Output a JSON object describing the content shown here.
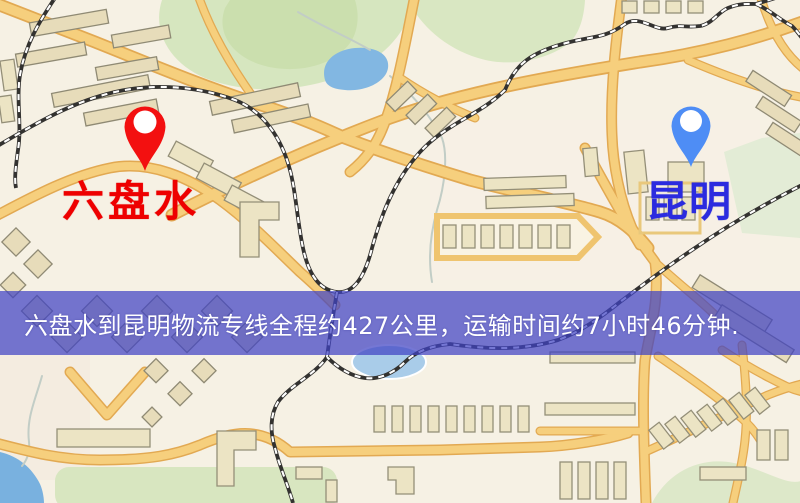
{
  "banner": {
    "text": "六盘水到昆明物流专线全程约427公里，运输时间约7小时46分钟.",
    "background_color": "#4042c4",
    "text_color": "#ffffff"
  },
  "markers": {
    "origin": {
      "name": "六盘水",
      "pin_color": "#f31010",
      "label_color": "#ee0000"
    },
    "destination": {
      "name": "昆明",
      "pin_color": "#4e8df5",
      "label_color": "#2b2bdf"
    }
  },
  "route": {
    "distance_km": "427",
    "duration": "7小时46分钟"
  },
  "map_colors": {
    "land": "#f6f1e4",
    "park": "#d6e6bf",
    "water": "#82b7e2",
    "road": "#f6cf7d",
    "road_casing": "#e2a952",
    "railway": "#333230",
    "building": "#ece4c4"
  }
}
